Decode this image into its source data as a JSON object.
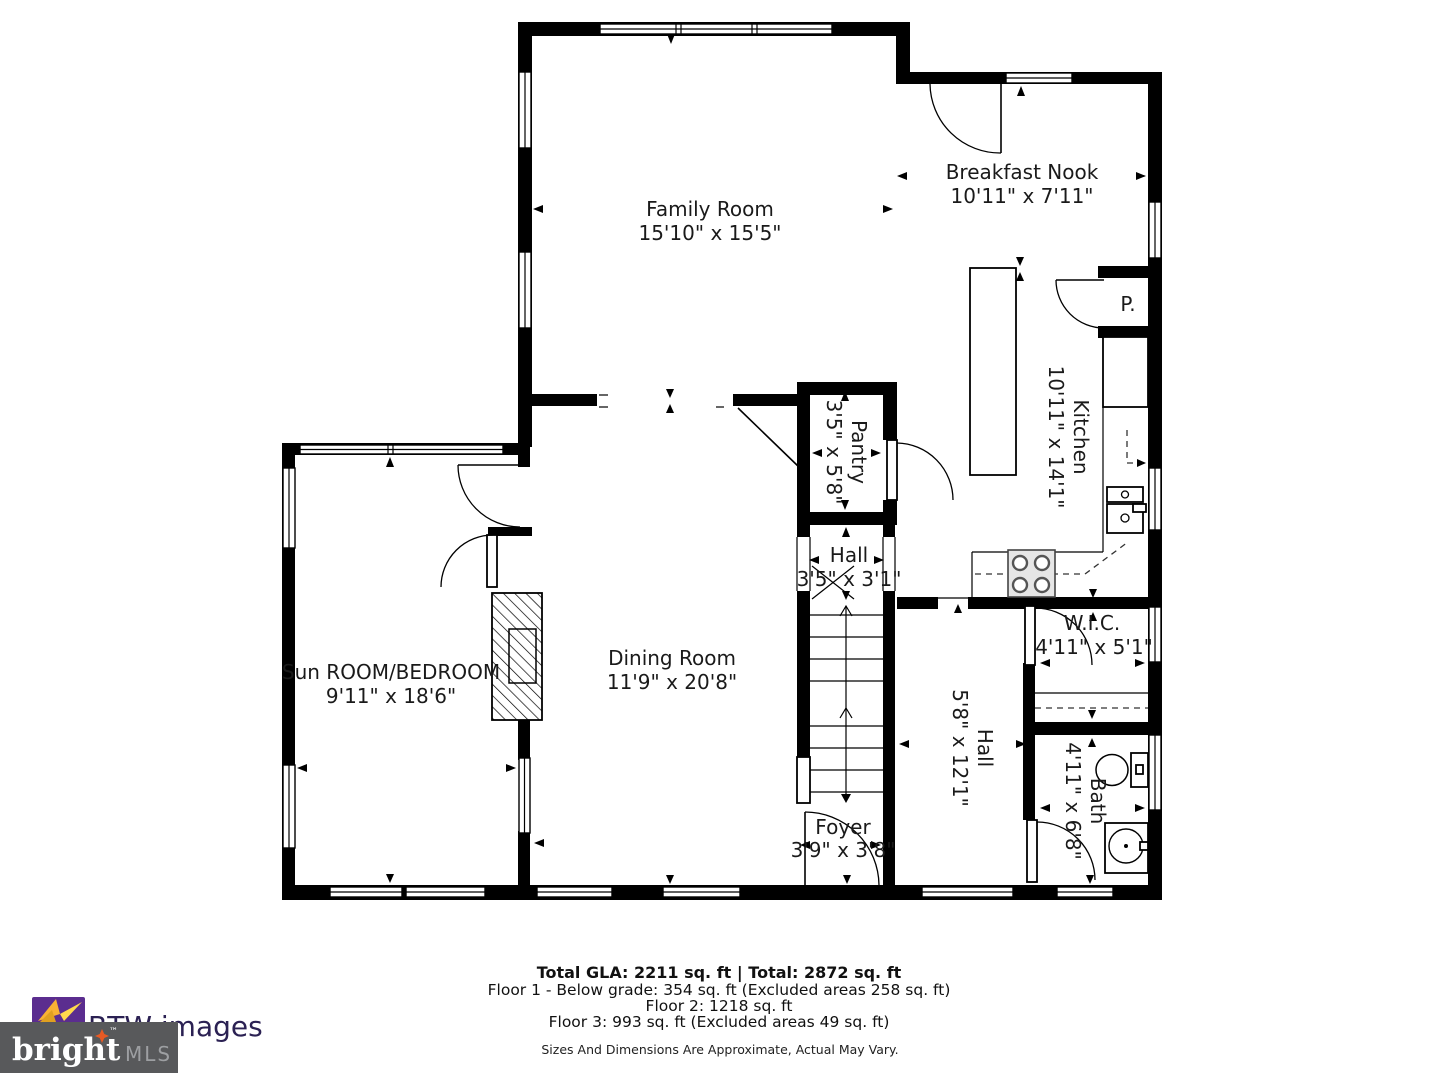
{
  "plan": {
    "rooms": {
      "family": {
        "name": "Family Room",
        "dims": "15'10\" x 15'5\""
      },
      "nook": {
        "name": "Breakfast Nook",
        "dims": "10'11\" x 7'11\""
      },
      "kitchen": {
        "name": "Kitchen",
        "dims": "10'11\" x 14'1\""
      },
      "pantry": {
        "name": "Pantry",
        "dims": "3'5\" x 5'8\""
      },
      "hall_upper": {
        "name": "Hall",
        "dims": "3'5\" x 3'1\""
      },
      "dining": {
        "name": "Dining Room",
        "dims": "11'9\" x 20'8\""
      },
      "sunroom": {
        "name": "Sun ROOM/BEDROOM",
        "dims": "9'11\" x 18'6\""
      },
      "wic": {
        "name": "W.I.C.",
        "dims": "4'11\" x 5'1\""
      },
      "hall_lower": {
        "name": "Hall",
        "dims": "5'8\" x 12'1\""
      },
      "bath": {
        "name": "Bath",
        "dims": "4'11\" x 6'8\""
      },
      "foyer": {
        "name": "Foyer",
        "dims": "3'9\" x 3'8\""
      },
      "pantry_closet": {
        "name": "P."
      }
    }
  },
  "footer": {
    "total": "Total GLA: 2211 sq. ft | Total: 2872 sq. ft",
    "floor1": "Floor 1 - Below grade: 354 sq. ft (Excluded areas 258 sq. ft)",
    "floor2": "Floor 2: 1218 sq. ft",
    "floor3": "Floor 3: 993 sq. ft (Excluded areas 49 sq. ft)",
    "disclaimer": "Sizes And Dimensions Are Approximate, Actual May Vary."
  },
  "branding": {
    "photo_credit": "BTW images",
    "mls_name": "bright",
    "mls_suffix": "MLS",
    "trademark": "™",
    "colors": {
      "mls_box": "#58595b",
      "mls_text": "#ffffff",
      "mls_suffix_text": "#9d9fa2",
      "credit_text": "#2b2153",
      "icon_purple": "#5b2d8f",
      "icon_yellow": "#ffc20e",
      "star_orange": "#e85a24"
    }
  }
}
